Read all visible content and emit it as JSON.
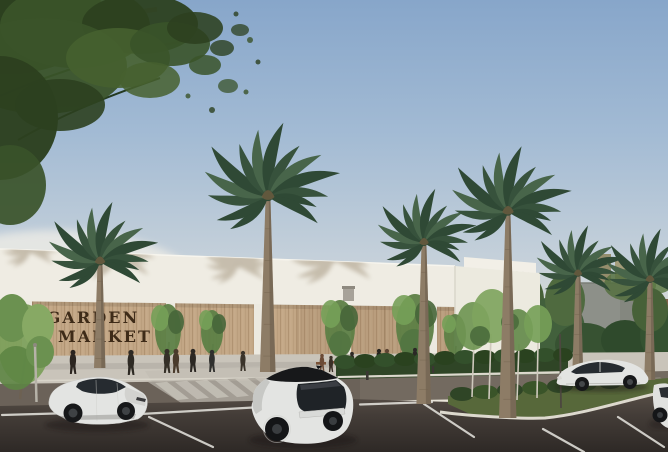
{
  "meta": {
    "type": "architectural-rendering",
    "subject": "supermarket exterior with palm trees and parking lot",
    "width": 668,
    "height": 452
  },
  "sign": {
    "line1": "GARDEN",
    "line2": "MARKET"
  },
  "palette": {
    "sky_top": "#87a6ca",
    "sky_horizon": "#efe9dc",
    "parapet": "#efece3",
    "white_volume": "#eceadf",
    "wood": "#c2a685",
    "sign_text": "#3e2b18",
    "shadow_tan": "#7c684a",
    "palm_frond": "#37523c",
    "palm_frond_light": "#48654a",
    "palm_frond_dark": "#2f4935",
    "palm_trunk": "#8d7c66",
    "canopy_dark": "#2c401f",
    "canopy_mid": "#3a5329",
    "canopy_light": "#46602f",
    "tree_green": "#5d7f46",
    "tree_green_light": "#76a058",
    "tree_green_dark": "#47663a",
    "plaza": "#c9c4ba",
    "road": "#6b6259",
    "asphalt_top": "#564e46",
    "asphalt_bottom": "#2f2a26",
    "curb": "#ddd9ce",
    "line_white": "#e8e6e0",
    "hedge": "#2f4526",
    "grass": "#57683a",
    "car_body": "#e3e4e2",
    "car_glass": "#262b30",
    "wheel": "#17181a",
    "concrete": "#8d9089",
    "brick": "#7d6148"
  },
  "scene": {
    "palms": [
      {
        "x": 100,
        "y": 262,
        "s": 1.05,
        "ground": 368
      },
      {
        "x": 268,
        "y": 197,
        "s": 1.3,
        "ground": 372
      },
      {
        "x": 424,
        "y": 243,
        "s": 0.95,
        "ground": 404
      },
      {
        "x": 508,
        "y": 212,
        "s": 1.15,
        "ground": 418
      },
      {
        "x": 578,
        "y": 274,
        "s": 0.85,
        "ground": 385
      },
      {
        "x": 650,
        "y": 280,
        "s": 0.9,
        "ground": 380
      }
    ],
    "palm_shadows": [
      {
        "x": 30,
        "y": 252,
        "s": 0.6
      },
      {
        "x": 116,
        "y": 258,
        "s": 0.85
      },
      {
        "x": 238,
        "y": 266,
        "s": 0.7
      },
      {
        "x": 334,
        "y": 260,
        "s": 0.95
      }
    ],
    "pedestrians": [
      [
        73,
        374,
        24,
        "#2b2520"
      ],
      [
        131,
        375,
        25,
        "#2e2a24"
      ],
      [
        167,
        373,
        24,
        "#353028"
      ],
      [
        176,
        373,
        24,
        "#4a3b2c"
      ],
      [
        193,
        372,
        23,
        "#2b2723"
      ],
      [
        212,
        372,
        22,
        "#30302e"
      ],
      [
        243,
        371,
        20,
        "#3a332a"
      ],
      [
        322,
        371,
        17,
        "#6b4a35"
      ],
      [
        331,
        372,
        16,
        "#3a2f26"
      ],
      [
        340,
        371,
        15,
        "#7a5038"
      ],
      [
        352,
        370,
        18,
        "#2e2a26"
      ],
      [
        379,
        369,
        20,
        "#26231f"
      ],
      [
        387,
        369,
        20,
        "#5d4432"
      ],
      [
        415,
        367,
        19,
        "#2b2826"
      ],
      [
        500,
        364,
        13,
        "#36322c"
      ],
      [
        548,
        362,
        12,
        "#3c362e"
      ]
    ]
  }
}
